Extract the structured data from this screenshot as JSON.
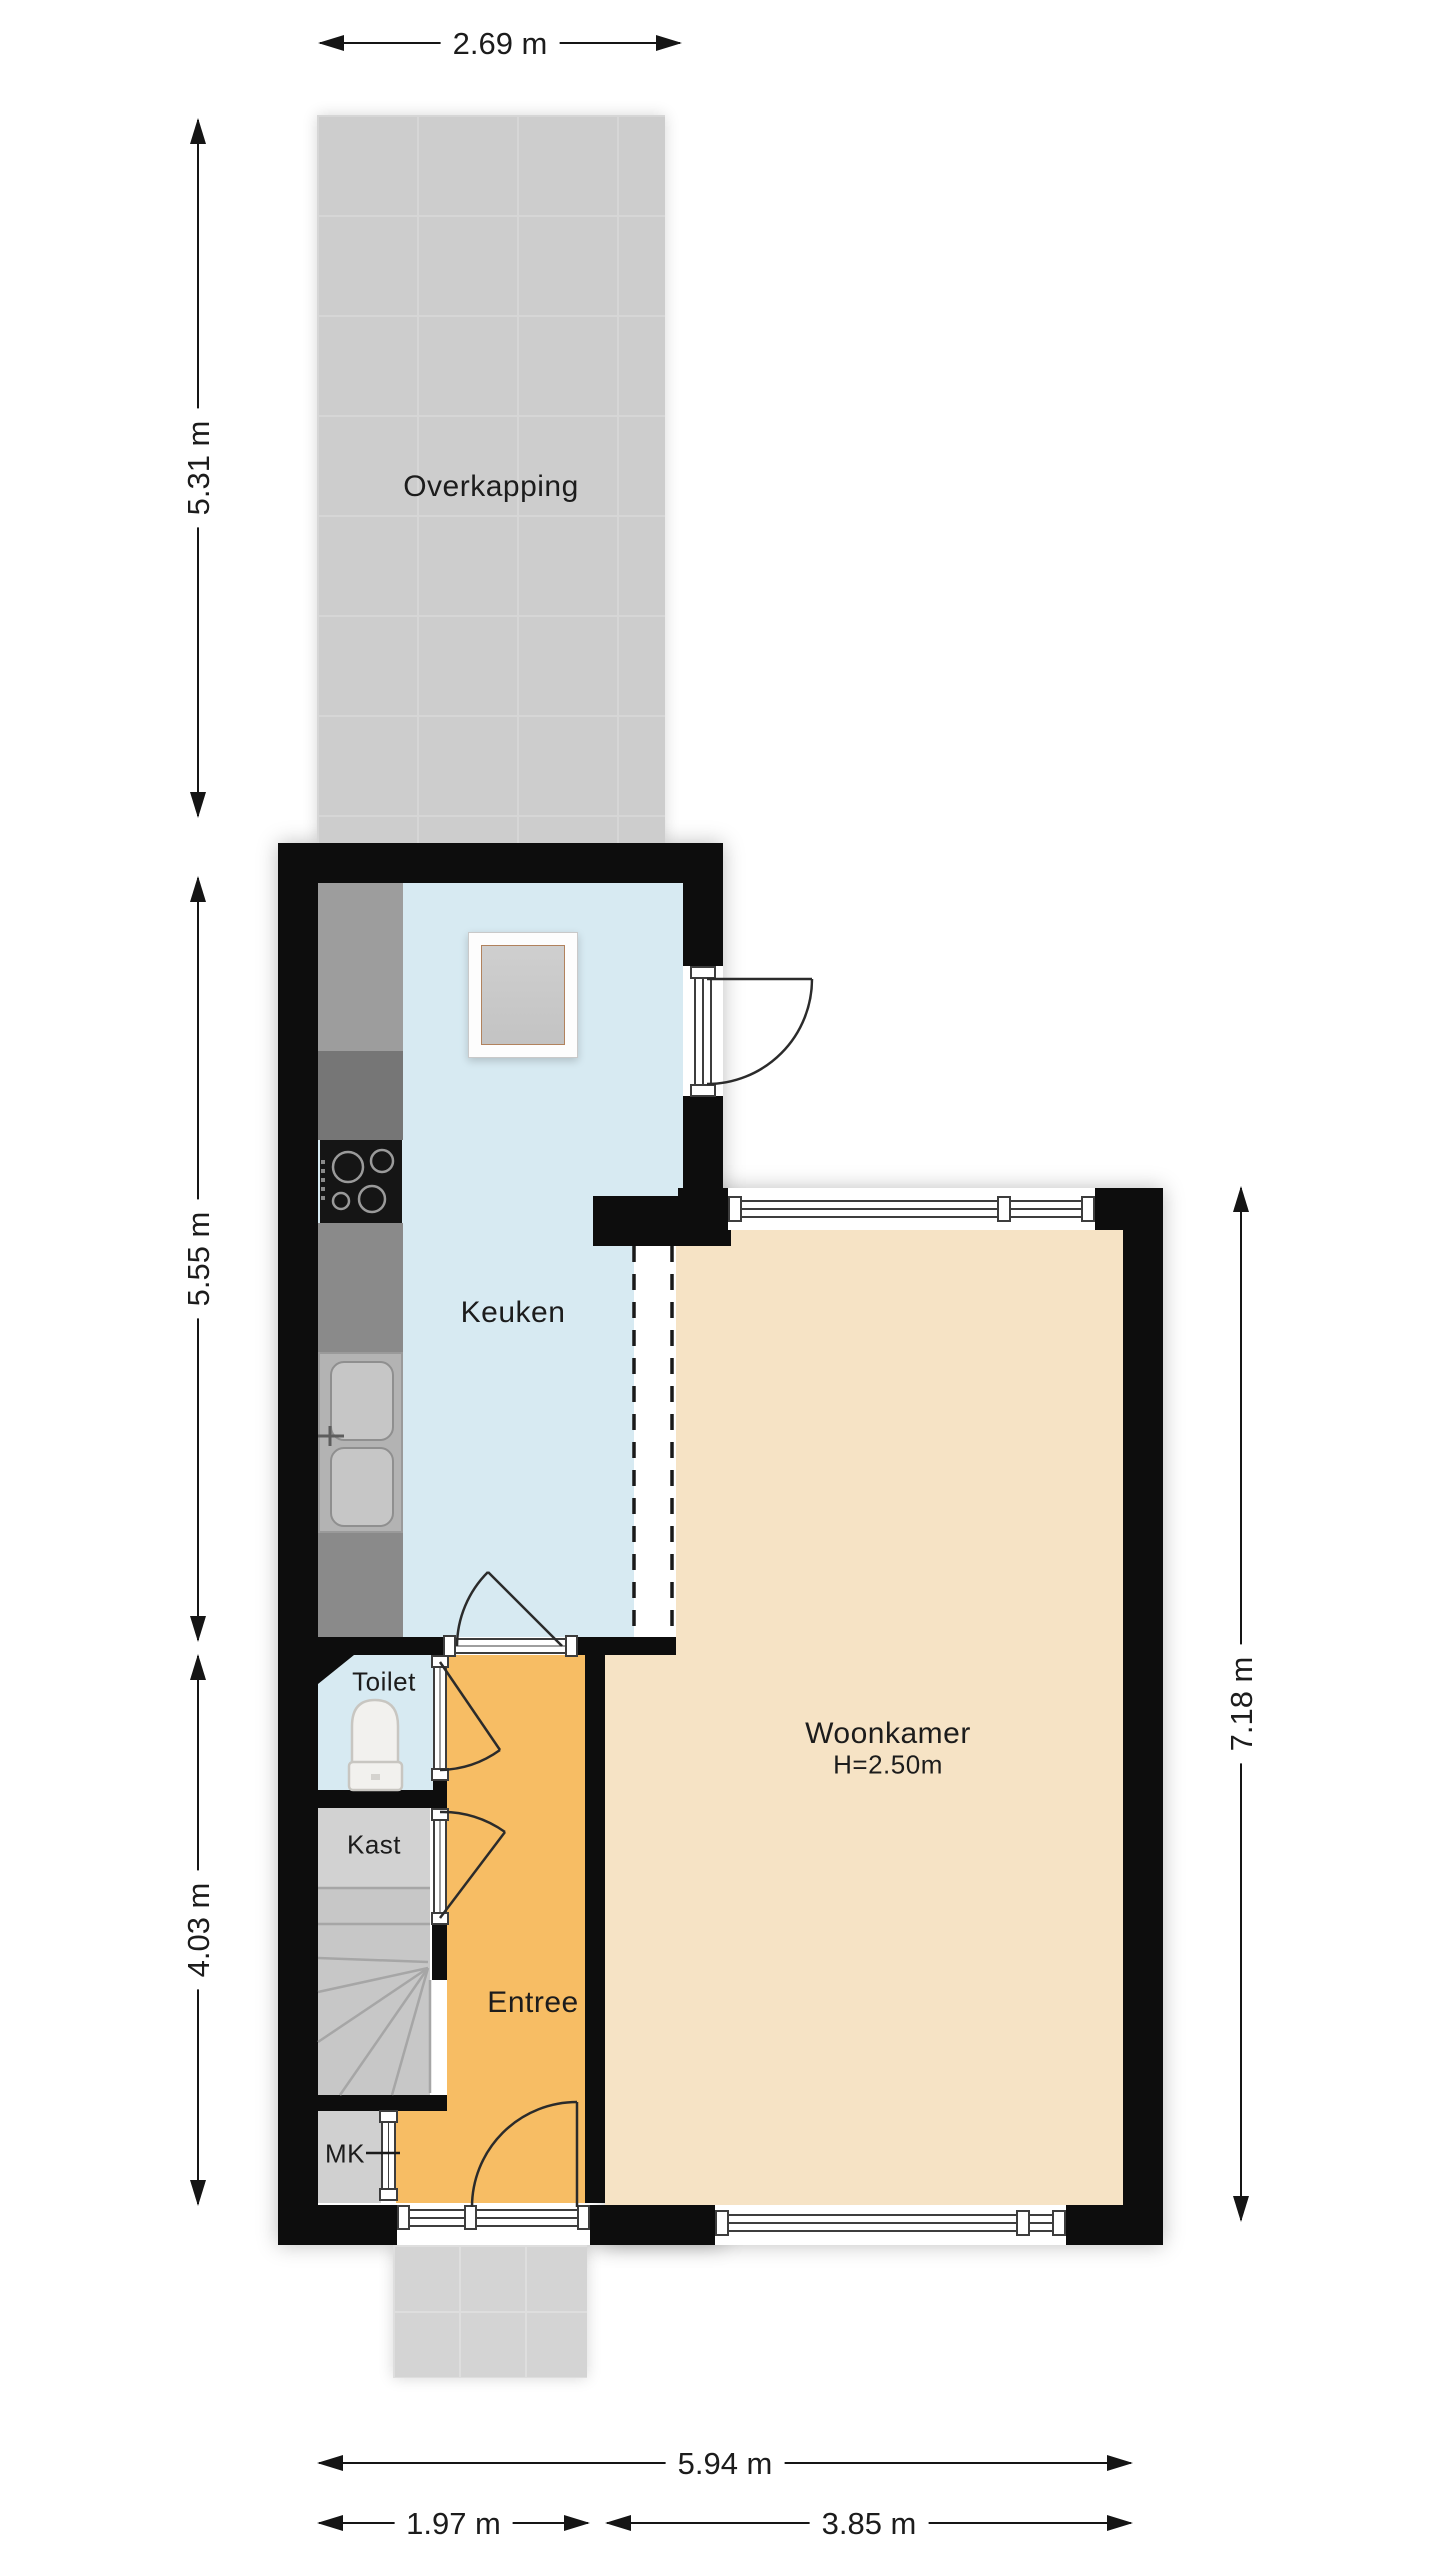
{
  "plan_title": "Begane grond plattegrond",
  "rooms": {
    "overkapping": {
      "label": "Overkapping"
    },
    "keuken": {
      "label": "Keuken"
    },
    "toilet": {
      "label": "Toilet"
    },
    "kast": {
      "label": "Kast"
    },
    "entree": {
      "label": "Entree"
    },
    "mk": {
      "label": "MK"
    },
    "woonkamer": {
      "label": "Woonkamer",
      "ceiling_height": "H=2.50m"
    }
  },
  "dimensions": {
    "top_width": "2.69 m",
    "left_overkapping": "5.31 m",
    "left_keuken": "5.55 m",
    "left_entree": "4.03 m",
    "right_woonkamer": "7.18 m",
    "bottom_total": "5.94 m",
    "bottom_left": "1.97 m",
    "bottom_right": "3.85 m"
  },
  "colors": {
    "wall": "#0d0d0d",
    "overkapping_floor": "#cdcdcd",
    "keuken_floor": "#d7eaf2",
    "toilet_floor": "#d7eaf2",
    "entree_floor": "#f7bd64",
    "woonkamer_floor": "#f6e3c5",
    "kast_floor": "#d2d2d2",
    "stairs_floor": "#c7c7c7",
    "mk_floor": "#d0d0d0",
    "porch_floor": "#d4d4d4",
    "counter_dark": "#767676",
    "counter_mid": "#9d9d9d",
    "sink_unit": "#b3b3b3"
  }
}
